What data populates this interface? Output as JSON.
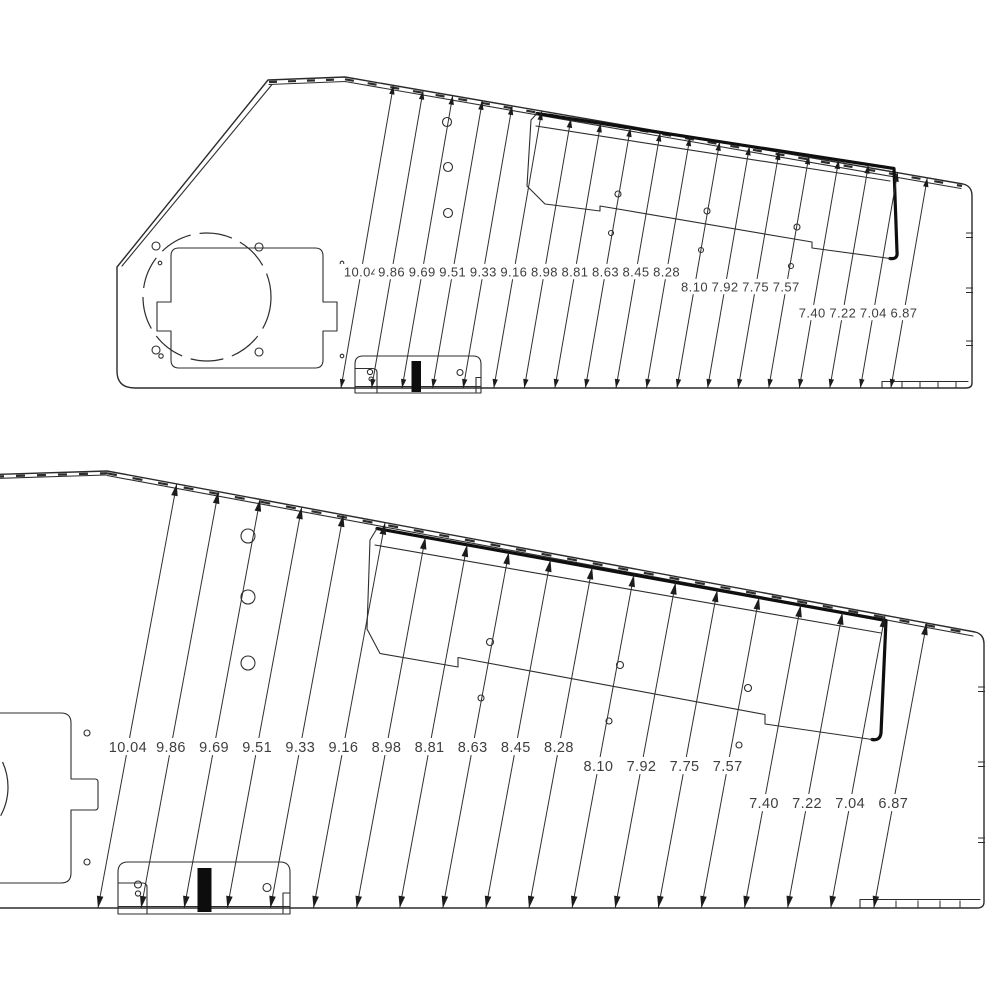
{
  "drawing": {
    "type": "technical-cad-drawing",
    "background": "#ffffff",
    "line_color": "#2d2d2d",
    "thick_line_color": "#0f0f0f",
    "label_color": "#3e3e3e",
    "views": [
      {
        "name": "side-panel-overview",
        "dimension_labels": [
          "10.04",
          "9.86",
          "9.69",
          "9.51",
          "9.33",
          "9.16",
          "8.98",
          "8.81",
          "8.63",
          "8.45",
          "8.28",
          "8.10",
          "7.92",
          "7.75",
          "7.57",
          "7.40",
          "7.22",
          "7.04",
          "6.87"
        ]
      },
      {
        "name": "side-panel-detail",
        "dimension_labels": [
          "10.04",
          "9.86",
          "9.69",
          "9.51",
          "9.33",
          "9.16",
          "8.98",
          "8.81",
          "8.63",
          "8.45",
          "8.28",
          "8.10",
          "7.92",
          "7.75",
          "7.57",
          "7.40",
          "7.22",
          "7.04",
          "6.87"
        ]
      }
    ]
  }
}
